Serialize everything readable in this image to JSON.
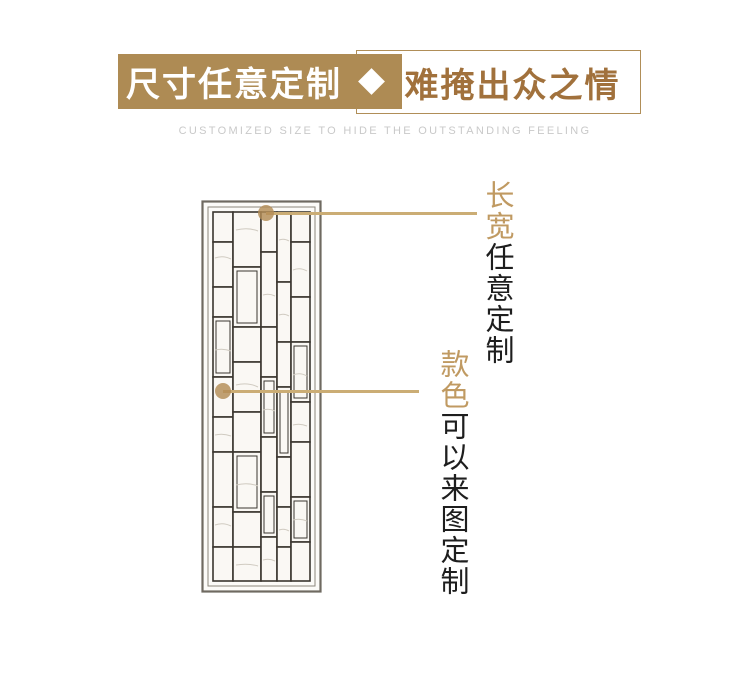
{
  "banner": {
    "left_label": "尺寸任意定制",
    "right_label": "难掩出众之情",
    "subtitle": "CUSTOMIZED SIZE TO HIDE THE OUTSTANDING FEELING"
  },
  "callouts": [
    {
      "highlight": "长宽",
      "detail": "任意定制"
    },
    {
      "highlight": "款色",
      "detail": "可以来图定制"
    }
  ],
  "product_image": {
    "description": "hand-drawn pencil sketch of a tall rectangular Chinese lattice screen partition"
  },
  "colors": {
    "banner_tan": "#AE8B54",
    "banner_text_brown": "#A1713C",
    "callout_gold_text": "#C09A62",
    "callout_line_gold": "#CBAD75",
    "callout_dot_gold": "#B38C56",
    "subtitle_gray": "#C9C9C9",
    "body_text_dark": "#1E1E1E",
    "sketch_stroke": "#3A362F"
  }
}
